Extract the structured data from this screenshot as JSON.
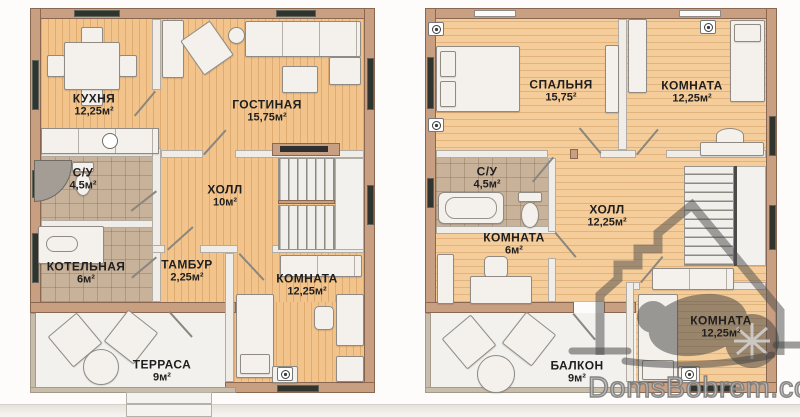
{
  "watermark": {
    "text": "DomsBobrem.com",
    "logo": "house-with-beaver"
  },
  "colors": {
    "wall": "#c89f81",
    "wall_edge": "#8a6750",
    "wood_floor": "#f2c48c",
    "wood_floor_right": "#f5cd9a",
    "tile_floor": "#c9b29a",
    "partition": "#f0ede8",
    "terrace_floor": "#f3f1ee",
    "furniture": "#f4f1ec",
    "window_slot": "#30342f",
    "label_text": "#1f1f1f",
    "watermark_gray": "#7e7e7e"
  },
  "floors": [
    {
      "id": "floor-1",
      "rooms": [
        {
          "name": "КУХНЯ",
          "area": "12,25м²"
        },
        {
          "name": "ГОСТИНАЯ",
          "area": "15,75м²"
        },
        {
          "name": "С/У",
          "area": "4,5м²"
        },
        {
          "name": "ХОЛЛ",
          "area": "10м²"
        },
        {
          "name": "КОТЕЛЬНАЯ",
          "area": "6м²"
        },
        {
          "name": "ТАМБУР",
          "area": "2,25м²"
        },
        {
          "name": "КОМНАТА",
          "area": "12,25м²"
        },
        {
          "name": "ТЕРРАСА",
          "area": "9м²"
        }
      ]
    },
    {
      "id": "floor-2",
      "rooms": [
        {
          "name": "СПАЛЬНЯ",
          "area": "15,75²"
        },
        {
          "name": "КОМНАТА",
          "area": "12,25м²"
        },
        {
          "name": "С/У",
          "area": "4,5м²"
        },
        {
          "name": "ХОЛЛ",
          "area": "12,25м²"
        },
        {
          "name": "КОМНАТА",
          "area": "6м²"
        },
        {
          "name": "КОМНАТА",
          "area": "12,25м²"
        },
        {
          "name": "БАЛКОН",
          "area": "9м²"
        }
      ]
    }
  ]
}
